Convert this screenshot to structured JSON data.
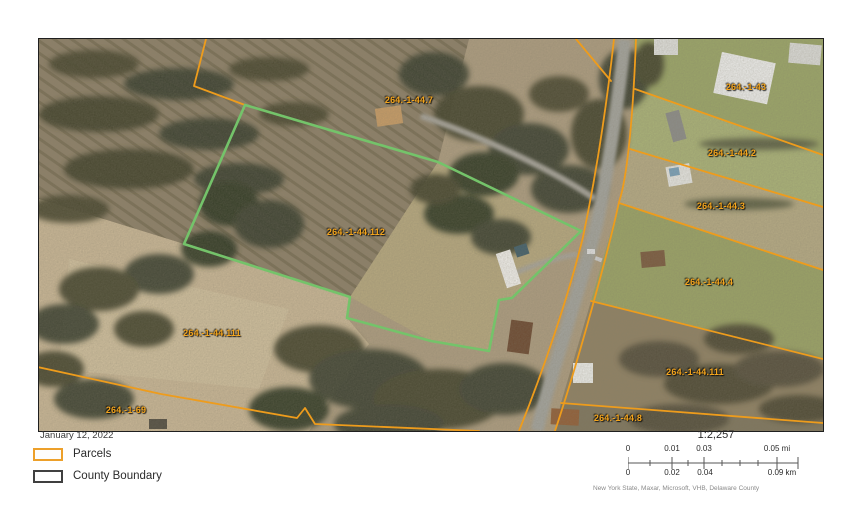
{
  "map": {
    "parcel_labels": [
      {
        "text": "264.-1-44.7"
      },
      {
        "text": "264.-1-43"
      },
      {
        "text": "264.-1-44.2"
      },
      {
        "text": "264.-1-44.3"
      },
      {
        "text": "264.-1-44.112"
      },
      {
        "text": "264.-1-44.4"
      },
      {
        "text": "264.-1-44.111"
      },
      {
        "text": "264.-1-44.111"
      },
      {
        "text": "264.-1-69"
      },
      {
        "text": "264.-1-44.8"
      }
    ],
    "colors": {
      "parcel_line": "#ee9c1c",
      "parcel_label": "#f4a51d",
      "subject_parcel_boundary": "#74c36a",
      "county_boundary": "#3f3f3f"
    }
  },
  "legend": {
    "date": "January 12, 2022",
    "items": [
      {
        "label": "Parcels"
      },
      {
        "label": "County Boundary"
      }
    ]
  },
  "scalebar": {
    "ratio": "1:2,257",
    "miles": [
      "0",
      "0.01",
      "0.03",
      "0.05 mi"
    ],
    "kilometers": [
      "0",
      "0.02",
      "0.04",
      "0.09 km"
    ]
  },
  "attribution": "New York State, Maxar, Microsoft, VHB, Delaware County"
}
